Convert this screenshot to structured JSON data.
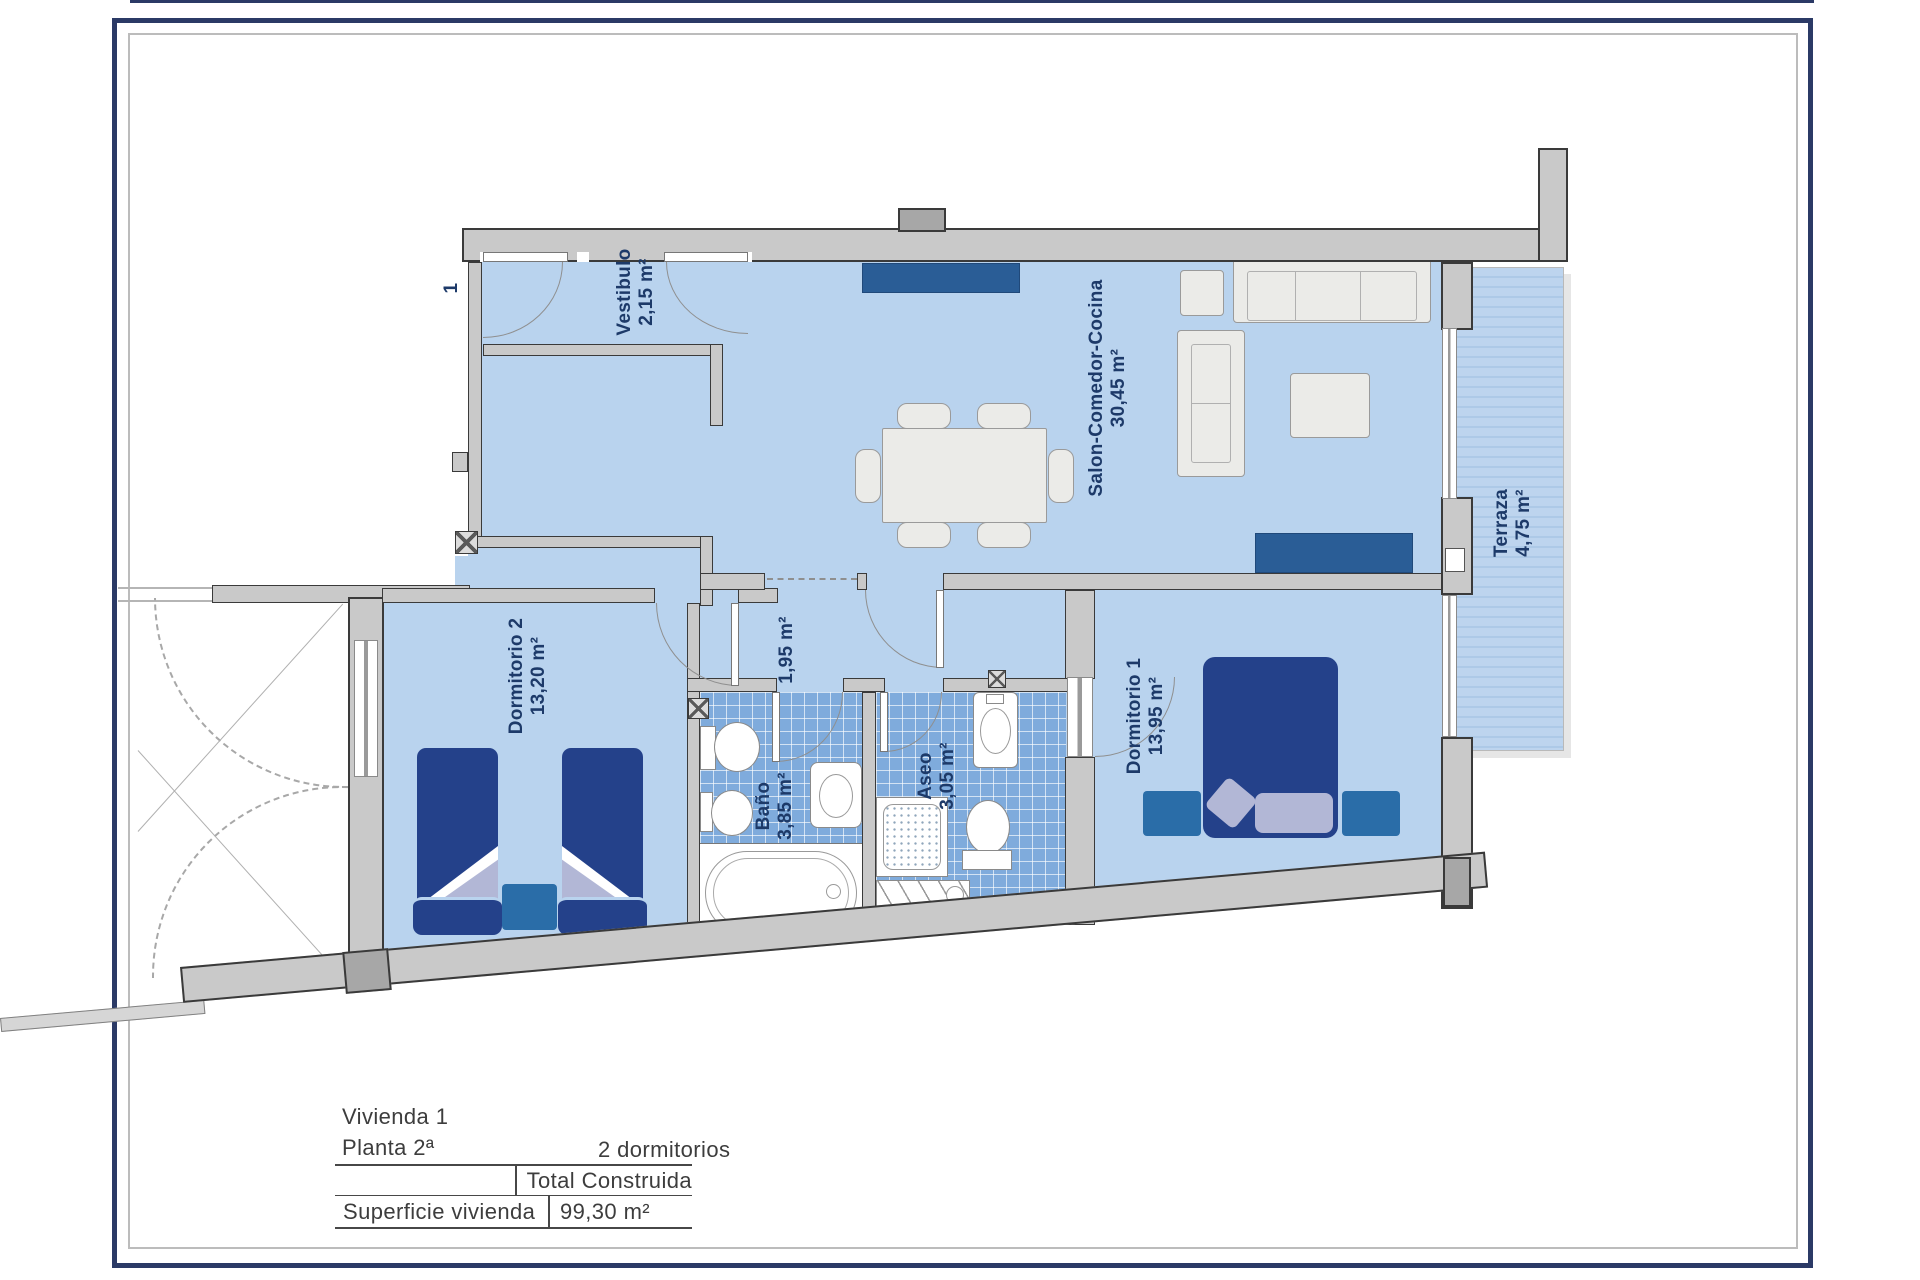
{
  "plan": {
    "unit_label": "1",
    "rooms": [
      {
        "name": "Vestibulo",
        "area": "2,15 m²"
      },
      {
        "name": "Salon-Comedor-Cocina",
        "area": "30,45 m²"
      },
      {
        "name": "Terraza",
        "area": "4,75 m²"
      },
      {
        "name": "Dormitorio 2",
        "area": "13,20 m²"
      },
      {
        "name": "",
        "area": "1,95 m²"
      },
      {
        "name": "Baño",
        "area": "3,85 m²"
      },
      {
        "name": "Aseo",
        "area": "3,05 m²"
      },
      {
        "name": "Dormitorio 1",
        "area": "13,95 m²"
      }
    ],
    "colors": {
      "floor": "#b9d3ee",
      "wall": "#c9c9c9",
      "furniture_navy": "#24418a",
      "furniture_blue": "#2a5d96",
      "accent_teal": "#2a6da8",
      "tile": "#7fabdc",
      "label_text": "#1d3a69",
      "frame": "#2b3a66"
    }
  },
  "info_block": {
    "unit_line": "Vivienda 1",
    "floor_line": "Planta 2ª",
    "bedrooms_line": "2 dormitorios",
    "table": {
      "header": "Total Construida",
      "row_label": "Superficie vivienda",
      "row_value": "99,30 m²"
    }
  }
}
